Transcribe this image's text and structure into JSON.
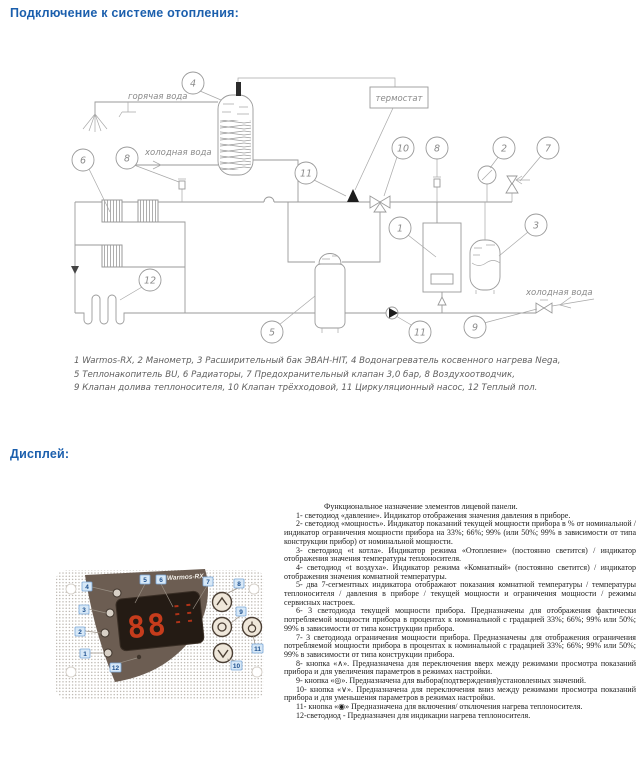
{
  "colors": {
    "heading_blue": "#1b5fad",
    "callout_blue": "#1c4f8e",
    "panel_brown": "#6c5d52",
    "digit_red": "#c63c1c"
  },
  "headings": {
    "connection": "Подключение к системе отопления:",
    "display": "Дисплей:"
  },
  "diagram": {
    "labels": {
      "hot_water": "горячая вода",
      "cold_water_top": "холодная вода",
      "cold_water_bottom": "холодная вода",
      "thermostat": "термостат"
    },
    "callout_numbers": [
      "4",
      "6",
      "8",
      "11",
      "10",
      "8",
      "2",
      "7",
      "1",
      "3",
      "5",
      "11",
      "9",
      "12"
    ],
    "caption_lines": [
      "1 Warmos-RX, 2 Манометр, 3 Расширительный бак ЭВАН-HIT, 4 Водонагреватель косвенного нагрева Nega,",
      "5 Теплонакопитель BU, 6 Радиаторы, 7 Предохранительный клапан 3,0 бар, 8 Воздухоотводчик,",
      "9 Клапан долива теплоносителя, 10 Клапан трёхходовой, 11 Циркуляционный насос, 12 Теплый пол."
    ]
  },
  "panel": {
    "brand": "Warmos-RX",
    "display_value": "88",
    "callouts": [
      "1",
      "2",
      "3",
      "4",
      "5",
      "6",
      "7",
      "8",
      "9",
      "10",
      "11",
      "12"
    ]
  },
  "description": {
    "intro": "Функциональное назначение элементов лицевой панели.",
    "items": [
      "1- светодиод «давление». Индикатор отображения значения давления в приборе.",
      "2- светодиод «мощность». Индикатор показаний текущей мощности прибора в % от номинальной / индикатор ограничения мощности прибора на 33%; 66%; 99% (или 50%; 99% в зависимости от типа конструкции прибор) от номинальной мощности.",
      "3- светодиод «t котла». Индикатор режима «Отопление» (постоянно светится) / индикатор отображения значения температуры теплоносителя.",
      "4- светодиод «t воздуха». Индикатор режима «Комнатный» (постоянно светится) / индикатор отображения значения комнатной температуры.",
      "5- два 7-сегментных индикатора отображают показания комнатной температуры / температуры теплоносителя / давления в приборе / текущей мощности и ограничения мощности / режимы сервисных настроек.",
      "6- 3 светодиода текущей мощности прибора. Предназначены для отображения фактически потребляемой мощности прибора в процентах к номинальной с градацией 33%; 66%; 99% или 50%; 99% в зависимости от типа конструкции прибора.",
      "7- 3 светодиода ограничения мощности прибора. Предназначены для отображения ограничения потребляемой мощности прибора в процентах к номинальной с градацией 33%; 66%; 99% или 50%; 99% в зависимости от типа конструкции прибора.",
      "8- кнопка «∧». Предназначена для переключения вверх между режимами просмотра показаний прибора и для увеличения параметров в режимах настройки.",
      "9- кнопка «◎». Предназначена для выбора(подтверждения)установленных значений.",
      "10- кнопка «∨». Предназначена для переключения вниз между режимами просмотра показаний прибора и для уменьшения параметров в режимах настройки.",
      "11- кнопка «◉» Предназначена для включения/ отключения нагрева теплоносителя.",
      "12-светодиод - Предназначен для индикации нагрева теплоносителя."
    ]
  }
}
